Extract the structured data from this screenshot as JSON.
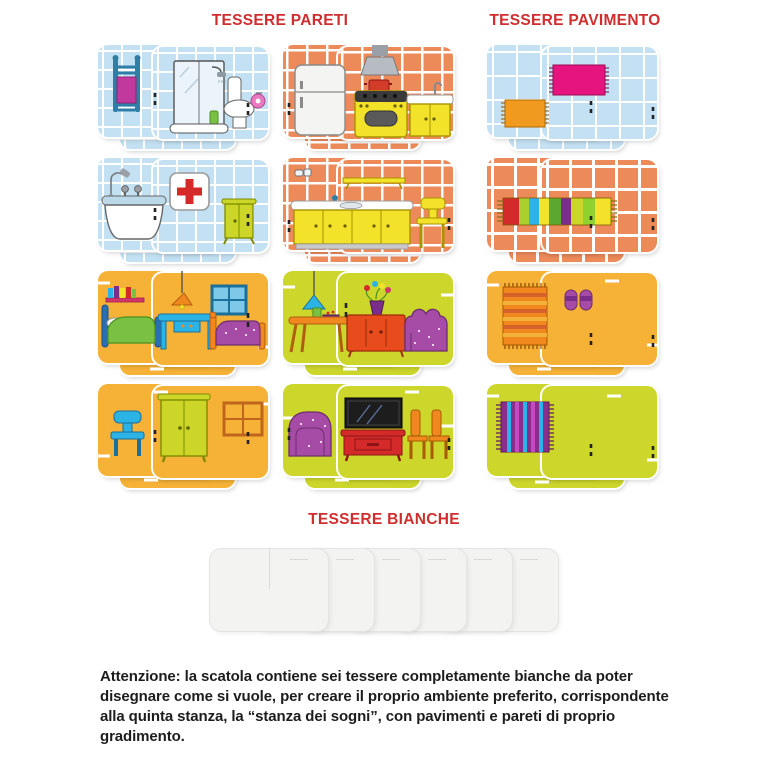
{
  "sections": {
    "walls": {
      "title": "TESSERE PARETI"
    },
    "floors": {
      "title": "TESSERE PAVIMENTO"
    },
    "blanks": {
      "title": "TESSERE BIANCHE"
    }
  },
  "colors": {
    "heading": "#d02e2e",
    "bathroom_tile": "#c3e1f2",
    "kitchen_tile": "#ec8a5a",
    "bedroom_tile": "#f6b237",
    "living_tile": "#ccd62b",
    "grid_line": "#ffffff",
    "blank_tile": "#f3f3f1",
    "footer_text": "#1d1d1b"
  },
  "wall_tile_groups": [
    {
      "row": 1,
      "room": "bathroom",
      "surface": "light-blue tiles",
      "items": [
        "towel rack with magenta towel",
        "shower stall",
        "toilet with pink paper roll"
      ]
    },
    {
      "row": 1,
      "room": "kitchen",
      "surface": "terracotta tiles",
      "items": [
        "fridge",
        "stove with hood and red pot",
        "sink cabinet"
      ]
    },
    {
      "row": 2,
      "room": "bathroom",
      "surface": "light-blue tiles",
      "items": [
        "bathtub with hand shower",
        "first aid box",
        "green cabinet"
      ]
    },
    {
      "row": 2,
      "room": "kitchen",
      "surface": "terracotta tiles",
      "items": [
        "jars",
        "wall shelf",
        "counter with sink",
        "yellow chair"
      ]
    },
    {
      "row": 3,
      "room": "bedroom",
      "surface": "amber wall",
      "items": [
        "bookshelf",
        "bed with green blanket",
        "pendant lamp",
        "blue desk",
        "blue window",
        "bed with purple blanket"
      ]
    },
    {
      "row": 3,
      "room": "living room",
      "surface": "chartreuse wall",
      "items": [
        "blue pendant lamp",
        "coffee table with bowl and cup",
        "sideboard with flower vase",
        "purple sofa"
      ]
    },
    {
      "row": 4,
      "room": "bedroom",
      "surface": "amber wall",
      "items": [
        "blue chair",
        "green wardrobe",
        "orange window"
      ]
    },
    {
      "row": 4,
      "room": "living room",
      "surface": "chartreuse wall",
      "items": [
        "purple armchair",
        "tv on red cabinet",
        "two orange chairs"
      ]
    }
  ],
  "floor_tile_groups": [
    {
      "row": 1,
      "surface": "light-blue tiles",
      "items": [
        "orange mat",
        "pink mat"
      ]
    },
    {
      "row": 2,
      "surface": "terracotta tiles",
      "items": [
        "multicolor striped rug"
      ]
    },
    {
      "row": 3,
      "surface": "amber floor",
      "items": [
        "striped runner rug",
        "purple slippers"
      ]
    },
    {
      "row": 4,
      "surface": "chartreuse floor",
      "items": [
        "purple striped rug"
      ]
    }
  ],
  "blank_tiles": {
    "count": 6
  },
  "footer": {
    "text": "Attenzione: la scatola contiene sei tessere completamente bianche da poter disegnare come si vuole, per creare il proprio ambiente preferito, corrispondente alla quinta stanza, la “stanza dei sogni”, con pavimenti e pareti di proprio gradimento."
  }
}
